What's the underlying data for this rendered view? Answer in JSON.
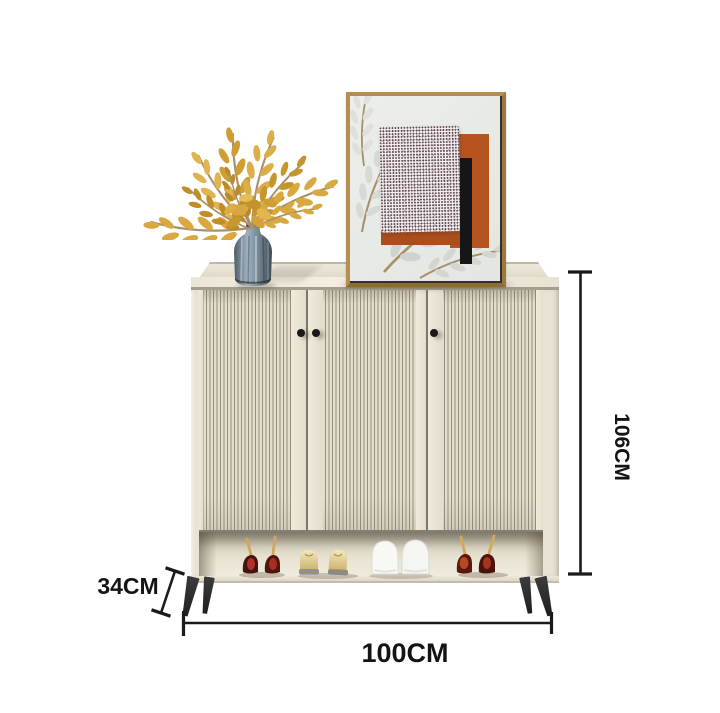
{
  "annotations": {
    "height": {
      "label": "106CM",
      "value": 106,
      "unit": "CM",
      "orientation": "vertical-right"
    },
    "width": {
      "label": "100CM",
      "value": 100,
      "unit": "CM",
      "orientation": "horizontal-bottom"
    },
    "depth": {
      "label": "34CM",
      "value": 34,
      "unit": "CM",
      "orientation": "diagonal-left"
    },
    "line_color": "#1a1a1a",
    "text_color": "#141414"
  },
  "scene": {
    "subject": "fluted-shoe-cabinet-product-photo",
    "background_color": "#ffffff",
    "cabinet": {
      "door_count": 3,
      "knob_count": 3,
      "body_color": "#e9e3d5",
      "flute_dark": "#968f7e",
      "flute_light": "#e4decf",
      "leg_color": "#2a2a2d",
      "open_shelf": true
    },
    "decor": {
      "artwork": {
        "frame_color": "#b3904f",
        "canvas_color": "#e9ebe7",
        "accent_orange": "#b5541f",
        "accent_black": "#161618"
      },
      "vase": {
        "glass_color": "#7c8f9e"
      },
      "foliage": {
        "color": "#d3a039"
      },
      "shoes": [
        "dark-red-stiletto-heels",
        "gold-flats",
        "white-sneakers",
        "maroon-stiletto-heels"
      ]
    }
  }
}
